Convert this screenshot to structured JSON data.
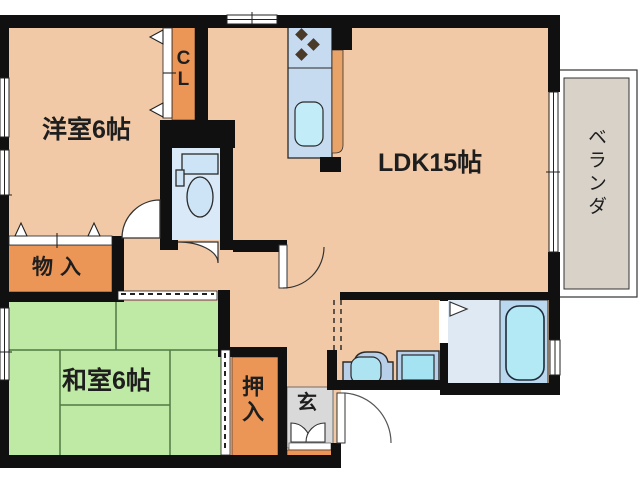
{
  "plan_title": "apartment-floor-plan",
  "rooms": {
    "western_room": {
      "label": "洋室6帖"
    },
    "ldk": {
      "label": "LDK15帖"
    },
    "japanese_room": {
      "label": "和室6帖"
    },
    "veranda": {
      "label": "ベランダ"
    },
    "storage": {
      "label": "物入"
    },
    "futon_closet": {
      "label": "押入"
    },
    "entrance": {
      "label": "玄"
    },
    "closet_cl": {
      "label": "CL"
    }
  },
  "fixtures": [
    "toilet",
    "kitchen-counter",
    "stove-burners",
    "kitchen-sink",
    "washbasin",
    "washing-machine",
    "bathtub",
    "entrance-door",
    "shoe-cabinet-doors",
    "sliding-windows",
    "accordion-closet-doors"
  ],
  "colors": {
    "wall": "#101010",
    "room_floor": "#f1c9a7",
    "tatami_green": "#bfeaa6",
    "tatami_line": "#4f7a42",
    "closet_orange": "#eb9556",
    "toilet_floor": "#d9e9f7",
    "changing_floor": "#dfe9f4",
    "bath_floor": "#b9d7ee",
    "tub_cyan": "#b2e9f4",
    "counter_blue": "#c6daf0",
    "sink_cyan": "#c2edf8",
    "appliance_blue": "#b7cfe9",
    "veranda_gray": "#d8d2c9",
    "entrance_gray": "#d9d9d9",
    "burner_brown": "#4a3a28",
    "label_text": "#1e1e1e"
  }
}
